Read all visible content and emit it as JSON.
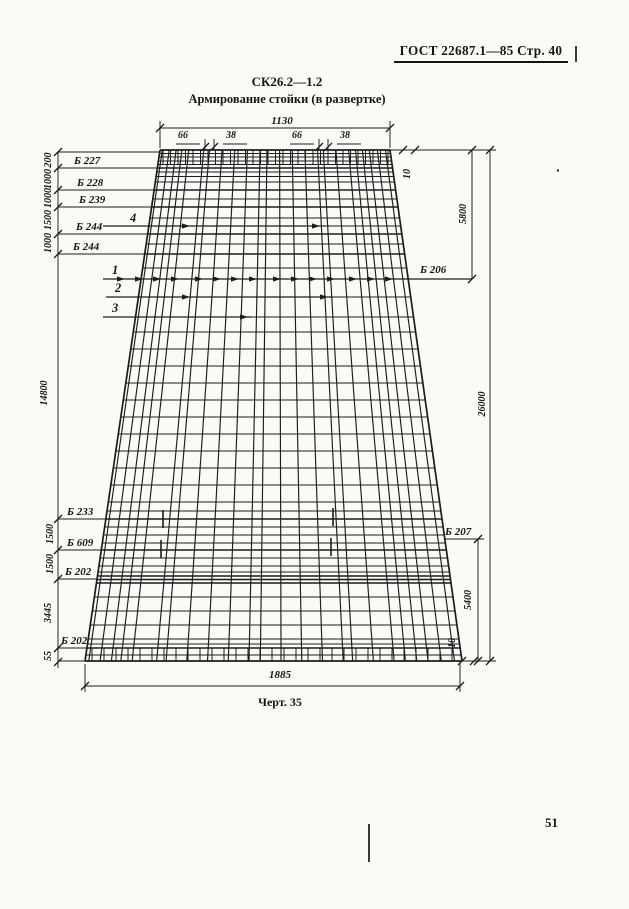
{
  "page": {
    "header": "ГОСТ 22687.1—85  Стр. 40",
    "number": "51"
  },
  "title": {
    "code": "СК26.2—1.2",
    "name": "Армирование стойки (в развертке)"
  },
  "caption": "Черт. 35",
  "dims": {
    "top_width": "1130",
    "sub_66": "66",
    "sub_38": "38",
    "col_left": [
      "200",
      "1000",
      "1000",
      "1500",
      "1000"
    ],
    "left_total": "14800",
    "col_left_bottom": [
      "1500",
      "1500",
      "3445",
      "55"
    ],
    "right": {
      "gap_top": "10",
      "upper": "5800",
      "total": "26000",
      "lower": "5400",
      "gap_bottom": "10"
    },
    "bottom_width": "1885"
  },
  "bars": {
    "b227": "Б 227",
    "b228": "Б 228",
    "b239": "Б 239",
    "b244": "Б 244",
    "b233": "Б 233",
    "b609": "Б 609",
    "b202": "Б 202",
    "b206": "Б 206",
    "b207": "Б 207"
  },
  "items": {
    "i1": "1",
    "i2": "2",
    "i3": "3",
    "i4": "4"
  },
  "ink_color": "#1c1c1c",
  "diagram": {
    "trapezoid": {
      "top_left": [
        160,
        150
      ],
      "top_right": [
        390,
        150
      ],
      "bottom_left": [
        85,
        661
      ],
      "bottom_right": [
        462,
        661
      ]
    },
    "vertical_fractions": [
      0.01,
      0.04,
      0.07,
      0.095,
      0.125,
      0.19,
      0.215,
      0.27,
      0.325,
      0.38,
      0.435,
      0.465,
      0.52,
      0.575,
      0.63,
      0.685,
      0.71,
      0.765,
      0.82,
      0.85,
      0.88,
      0.91,
      0.945,
      0.98
    ],
    "rows": [
      153.5,
      157,
      161,
      164.5,
      168,
      172,
      176.5,
      182,
      190,
      199,
      207,
      218,
      226,
      234,
      244,
      254,
      268,
      279,
      297,
      317,
      332,
      349,
      366,
      383,
      400,
      417,
      434,
      451,
      468,
      485,
      502,
      511,
      519,
      527,
      535,
      543,
      550,
      558,
      566,
      572,
      576,
      579.5,
      583,
      597,
      611,
      625,
      639,
      644,
      648,
      655
    ],
    "thick_rows": [
      168,
      190,
      207,
      234,
      254,
      519,
      550,
      576,
      579.5,
      583,
      648
    ],
    "left_leader_rows": [
      152,
      168,
      190,
      207,
      234,
      254,
      519,
      550,
      579,
      648,
      661
    ],
    "left_dim_x": 58,
    "left_dim_span": [
      152,
      668
    ],
    "left_dim_ticks": [
      152,
      168,
      190,
      207,
      234,
      254,
      519,
      550,
      579,
      648,
      662
    ],
    "top_dim": {
      "y": 128,
      "x1": 160,
      "x2": 390,
      "ext_top": 121
    },
    "sub_dims": [
      {
        "x": 178
      },
      {
        "x": 292
      }
    ],
    "top_ext": {
      "y": 150,
      "x2": 496
    },
    "top10_ticks": [
      [
        403,
        150
      ],
      [
        415,
        150
      ]
    ],
    "right_dims": [
      {
        "x": 472,
        "y1": 150,
        "y2": 279
      },
      {
        "x": 490,
        "y1": 150,
        "y2": 661
      },
      {
        "x": 478,
        "y1": 539,
        "y2": 661
      }
    ],
    "b207_leader": {
      "y": 539,
      "x1": 445,
      "x2": 484
    },
    "bottom_ext": {
      "y": 661,
      "x2": 496
    },
    "bottom10_ticks": [
      [
        462,
        661
      ],
      [
        474,
        661
      ]
    ],
    "bottom_dim": {
      "y": 686,
      "x1": 85,
      "x2": 460,
      "ext_y1": 664,
      "ext_y2": 692
    },
    "arrows": {
      "row1": {
        "y": 279,
        "x1": 103,
        "x2": 472,
        "heads": [
          125,
          143,
          161,
          179,
          203,
          221,
          239,
          257,
          281,
          299,
          317,
          335,
          357,
          375,
          393
        ]
      },
      "row2": {
        "y": 297,
        "x1": 106,
        "x2": 333,
        "heads": [
          190,
          328
        ]
      },
      "row3": {
        "y": 317,
        "x1": 103,
        "x2": 252,
        "heads": [
          248
        ]
      },
      "row4": {
        "y": 226,
        "x1": 103,
        "x2": 325,
        "heads": [
          190,
          320
        ]
      }
    },
    "stirrups": [
      [
        163,
        510,
        528
      ],
      [
        333,
        508,
        526
      ],
      [
        161,
        540,
        558
      ],
      [
        331,
        538,
        556
      ]
    ],
    "combs": {
      "top": {
        "y1": 150,
        "y2": 164,
        "x1": 163,
        "x2": 388,
        "step": 7.5
      },
      "bottom": {
        "y1": 648,
        "y2": 661,
        "x1": 92,
        "x2": 452,
        "step": 12
      }
    }
  }
}
